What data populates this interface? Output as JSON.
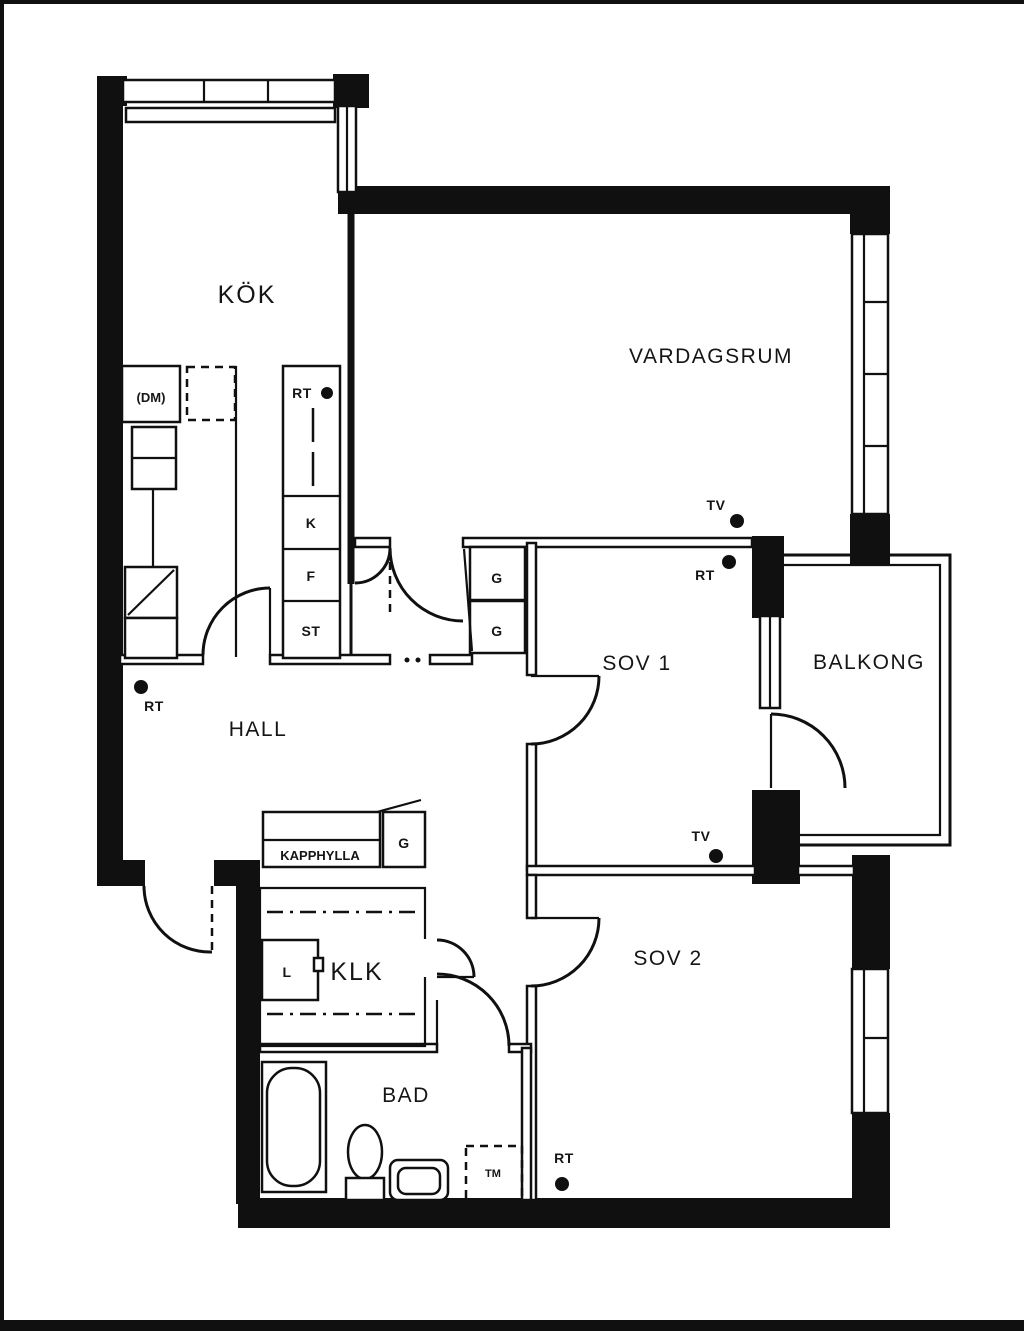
{
  "plan": {
    "rooms": {
      "kok": "KÖK",
      "vardagsrum": "VARDAGSRUM",
      "sov1": "SOV 1",
      "sov2": "SOV 2",
      "balkong": "BALKONG",
      "hall": "HALL",
      "klk": "KLK",
      "bad": "BAD"
    },
    "closets": {
      "k": "K",
      "f": "F",
      "st": "ST",
      "g": "G",
      "l": "L",
      "kapphylla": "KAPPHYLLA"
    },
    "appliances": {
      "dm": "(DM)",
      "tm": "TM"
    },
    "markers": {
      "rt": "RT",
      "tv": "TV"
    },
    "colors": {
      "ink": "#101010",
      "paper": "#ffffff"
    }
  }
}
